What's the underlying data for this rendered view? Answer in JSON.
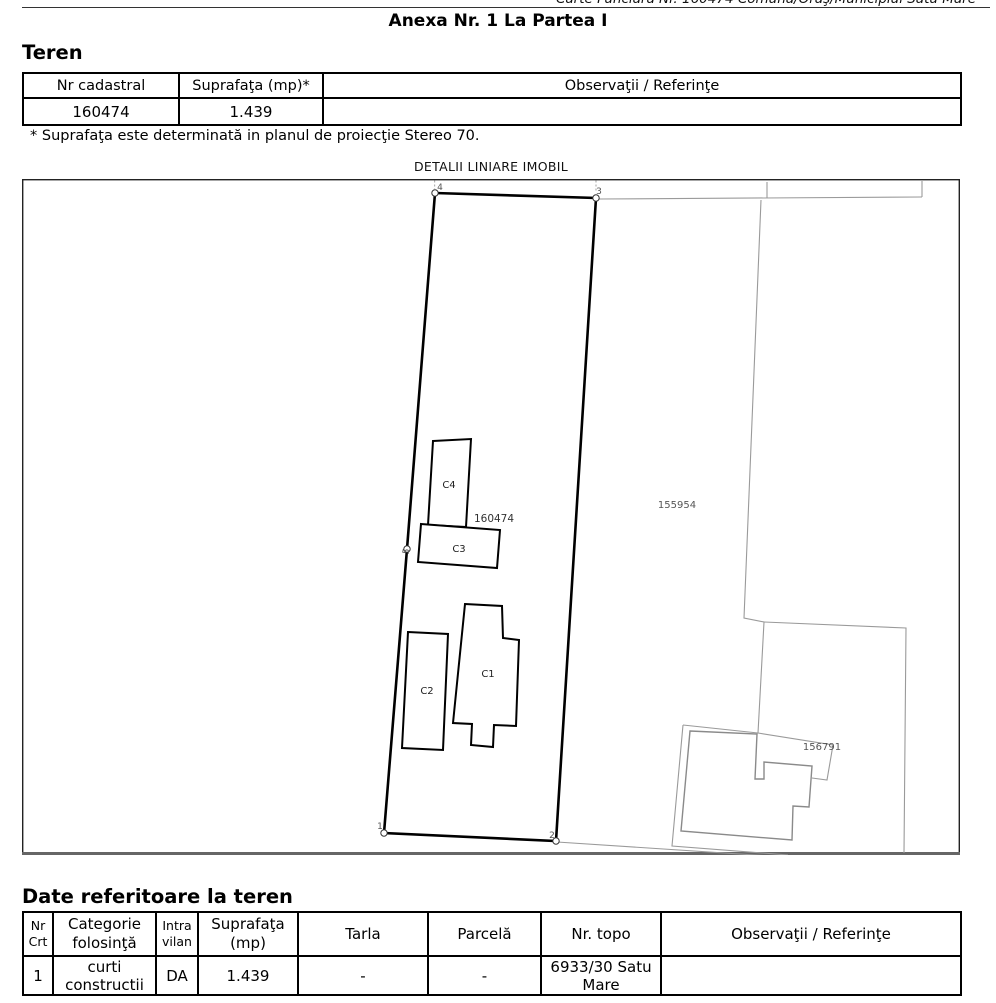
{
  "page": {
    "top_line": "Carte Funciara Nr. 160474 Comuna/Oraş/Municipiul Satu Mare",
    "title": "Anexa Nr. 1 La Partea I"
  },
  "teren": {
    "heading": "Teren",
    "col_nr_cadastral": "Nr cadastral",
    "col_suprafata": "Suprafaţa (mp)*",
    "col_observatii": "Observaţii / Referinţe",
    "row": {
      "nr_cadastral": "160474",
      "suprafata": "1.439",
      "observatii": ""
    },
    "footnote": "* Suprafaţa este determinată in planul de proiecţie Stereo 70."
  },
  "map": {
    "title": "DETALII LINIARE IMOBIL",
    "parcel_label": "160474",
    "building_labels": {
      "c1": "C1",
      "c2": "C2",
      "c3": "C3",
      "c4": "C4"
    },
    "neighbor_labels": {
      "right": "155954",
      "bottom_right": "156791"
    },
    "vertex_labels": {
      "v1": "1",
      "v2": "2",
      "v3": "3",
      "v4": "4",
      "v5": "5"
    }
  },
  "date_teren": {
    "heading": "Date referitoare la teren",
    "columns": {
      "nr_crt": [
        "Nr",
        "Crt"
      ],
      "categorie": [
        "Categorie",
        "folosinţă"
      ],
      "intravilan": [
        "Intra",
        "vilan"
      ],
      "suprafata": [
        "Suprafaţa",
        "(mp)"
      ],
      "tarla": "Tarla",
      "parcela": "Parcelă",
      "nr_topo": "Nr. topo",
      "observatii": "Observaţii / Referinţe"
    },
    "row": {
      "nr_crt": "1",
      "categorie": "curti constructii",
      "intravilan": "DA",
      "suprafata": "1.439",
      "tarla": "-",
      "parcela": "-",
      "nr_topo": "6933/30 Satu Mare",
      "observatii": ""
    }
  }
}
